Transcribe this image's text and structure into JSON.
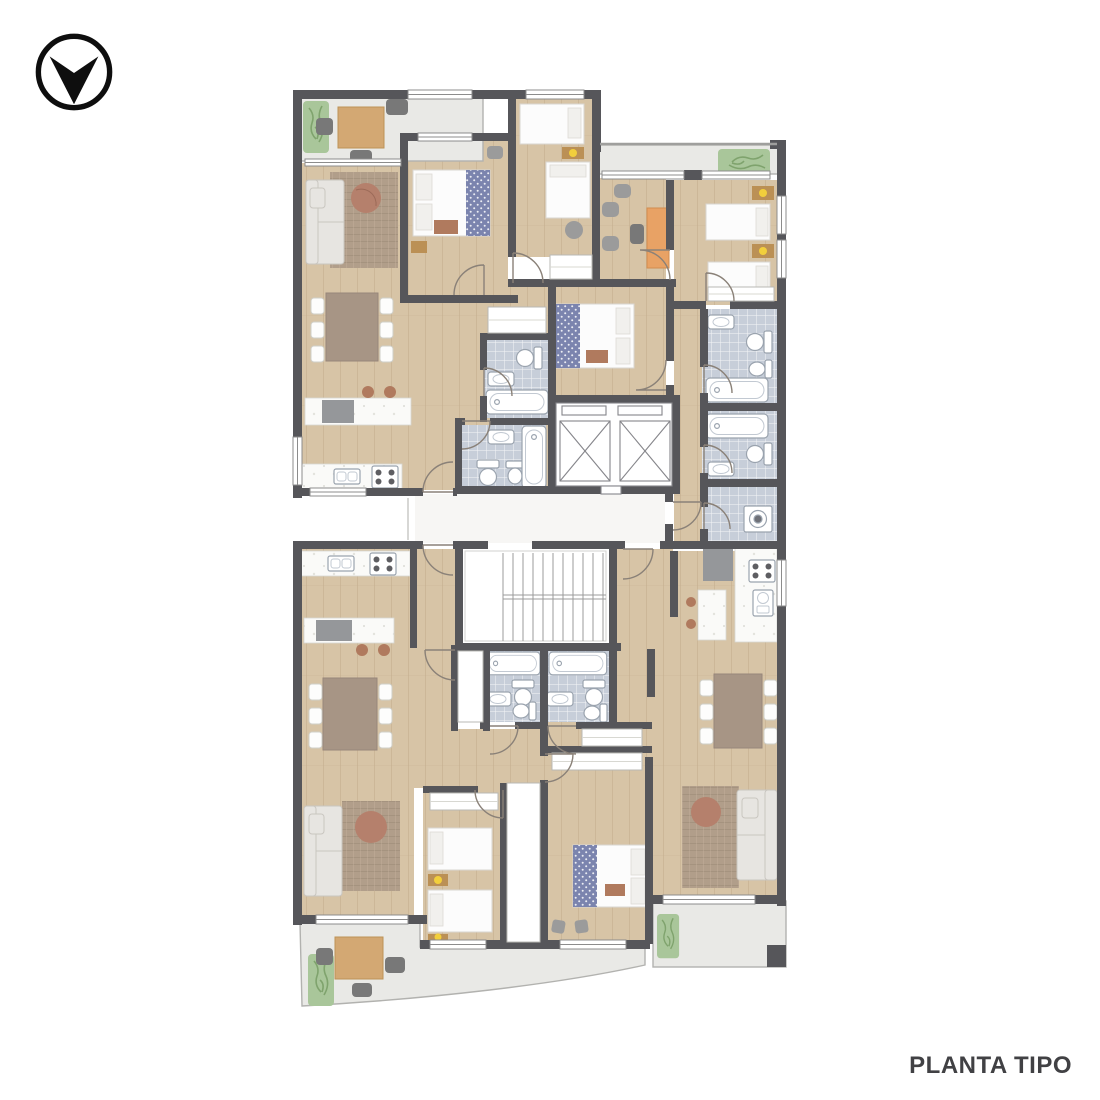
{
  "page": {
    "background": "#ffffff",
    "title": "PLANTA TIPO"
  },
  "logo": {
    "icon": "chevron-down-circle-logo-icon",
    "color": "#0e0e0e"
  },
  "plan": {
    "type": "residential-floor-plan",
    "floor_label": "PLANTA TIPO",
    "units": [
      "north-west-apartment",
      "north-east-apartment",
      "south-west-apartment",
      "south-east-apartment"
    ],
    "circulation": [
      "entrance-hall",
      "staircase",
      "elevator",
      "elevator"
    ],
    "room_kinds": [
      "living-dining",
      "kitchen",
      "bedroom",
      "bathroom",
      "laundry",
      "study",
      "balcony-terrace",
      "light-well"
    ],
    "elevator_count": 2,
    "bathtub_count": 6,
    "balcony_count": 4
  },
  "colors": {
    "pageBg": "#ffffff",
    "wall": "#56565a",
    "floor": "#d7c4a6",
    "floorLine": "#c3ad8c",
    "tile": "#c7ced9",
    "balcony": "#e9e9e6",
    "balconyEdge": "#b2b2af",
    "hall": "#f7f6f4",
    "rug": "#b19e8a",
    "rugRound": "#b5806c",
    "sofa": "#e7e5e1",
    "sofaEdge": "#c9c6c0",
    "marble": "#fafaf8",
    "furnWood": "#d3a873",
    "tableTop": "#a79585",
    "chairWhite": "#fdfdfc",
    "chairGray": "#9b9b9b",
    "chairDark": "#787878",
    "desk": "#e8a265",
    "bedWhite": "#fcfcfc",
    "bedPattern": "#7b84ae",
    "pillow": "#f1f0ed",
    "rust": "#b07a5e",
    "nightstand": "#bb9055",
    "lamp": "#f2cf3c",
    "plant": "#a9c69a",
    "plantDark": "#7fa36d",
    "appliance": "#95979a",
    "fixture": "#9aa3ae",
    "door": "#8a8178",
    "windowLine": "#8c8c8c",
    "stair": "#9b9b9b",
    "shaft": "#85858a",
    "title": "#414144",
    "logo": "#0e0e0e"
  }
}
